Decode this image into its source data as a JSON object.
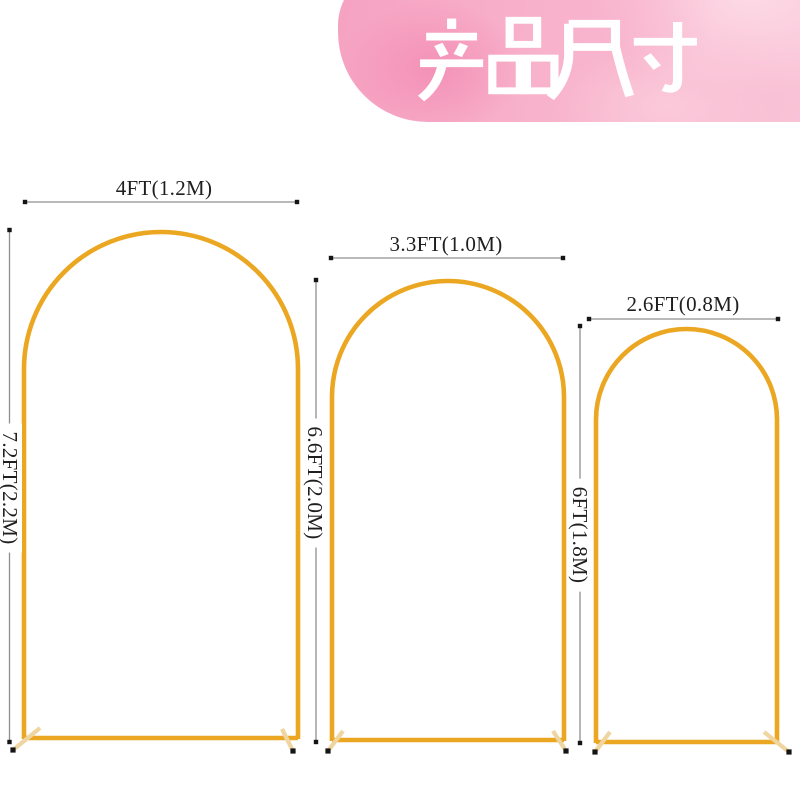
{
  "page": {
    "background": "#ffffff"
  },
  "banner": {
    "title": "产品尺寸",
    "title_chars": [
      "产",
      "品",
      "尺",
      "寸"
    ],
    "text_color": "#ffffff",
    "bg_pink": "#f6a2c2",
    "bg_pink_light": "#fbd6e2"
  },
  "diagram": {
    "arches": [
      {
        "size": "large",
        "width_label": "4FT(1.2M)",
        "height_label": "7.2FT(2.2M)"
      },
      {
        "size": "medium",
        "width_label": "3.3FT(1.0M)",
        "height_label": "6.6FT(2.0M)"
      },
      {
        "size": "small",
        "width_label": "2.6FT(0.8M)",
        "height_label": "6FT(1.8M)"
      }
    ],
    "colors": {
      "frame_gold": "#eba722",
      "foot_tan": "#efd6a0",
      "cap_dark": "#151515",
      "dim_line_gray": "#8f8f8f",
      "label_text": "#1f1f1f"
    }
  }
}
